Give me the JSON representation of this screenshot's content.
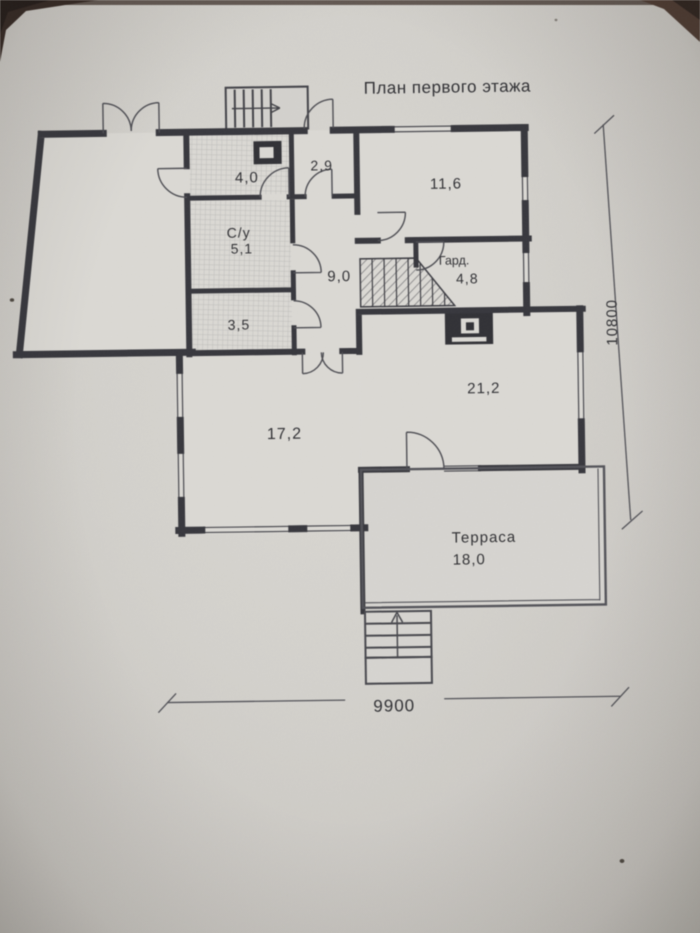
{
  "photo": {
    "colors": {
      "paper": "#d3d1cc",
      "ink": "#35353b",
      "table_corner": "#31241f"
    }
  },
  "plan": {
    "title": "План первого этажа",
    "rooms": {
      "storage": {
        "area": "4,0"
      },
      "vestibule": {
        "area": "2,9"
      },
      "bedroom": {
        "area": "11,6"
      },
      "bathroom": {
        "name": "С/у",
        "area": "5,1"
      },
      "hallway": {
        "area": "9,0"
      },
      "wardrobe": {
        "name": "Гард.",
        "area": "4,8"
      },
      "pantry": {
        "area": "3,5"
      },
      "living": {
        "area": "21,2"
      },
      "room_17_2": {
        "area": "17,2"
      },
      "terrace": {
        "name": "Терраса",
        "area": "18,0"
      }
    },
    "dimensions": {
      "width_mm": "9900",
      "height_mm": "10800"
    }
  }
}
